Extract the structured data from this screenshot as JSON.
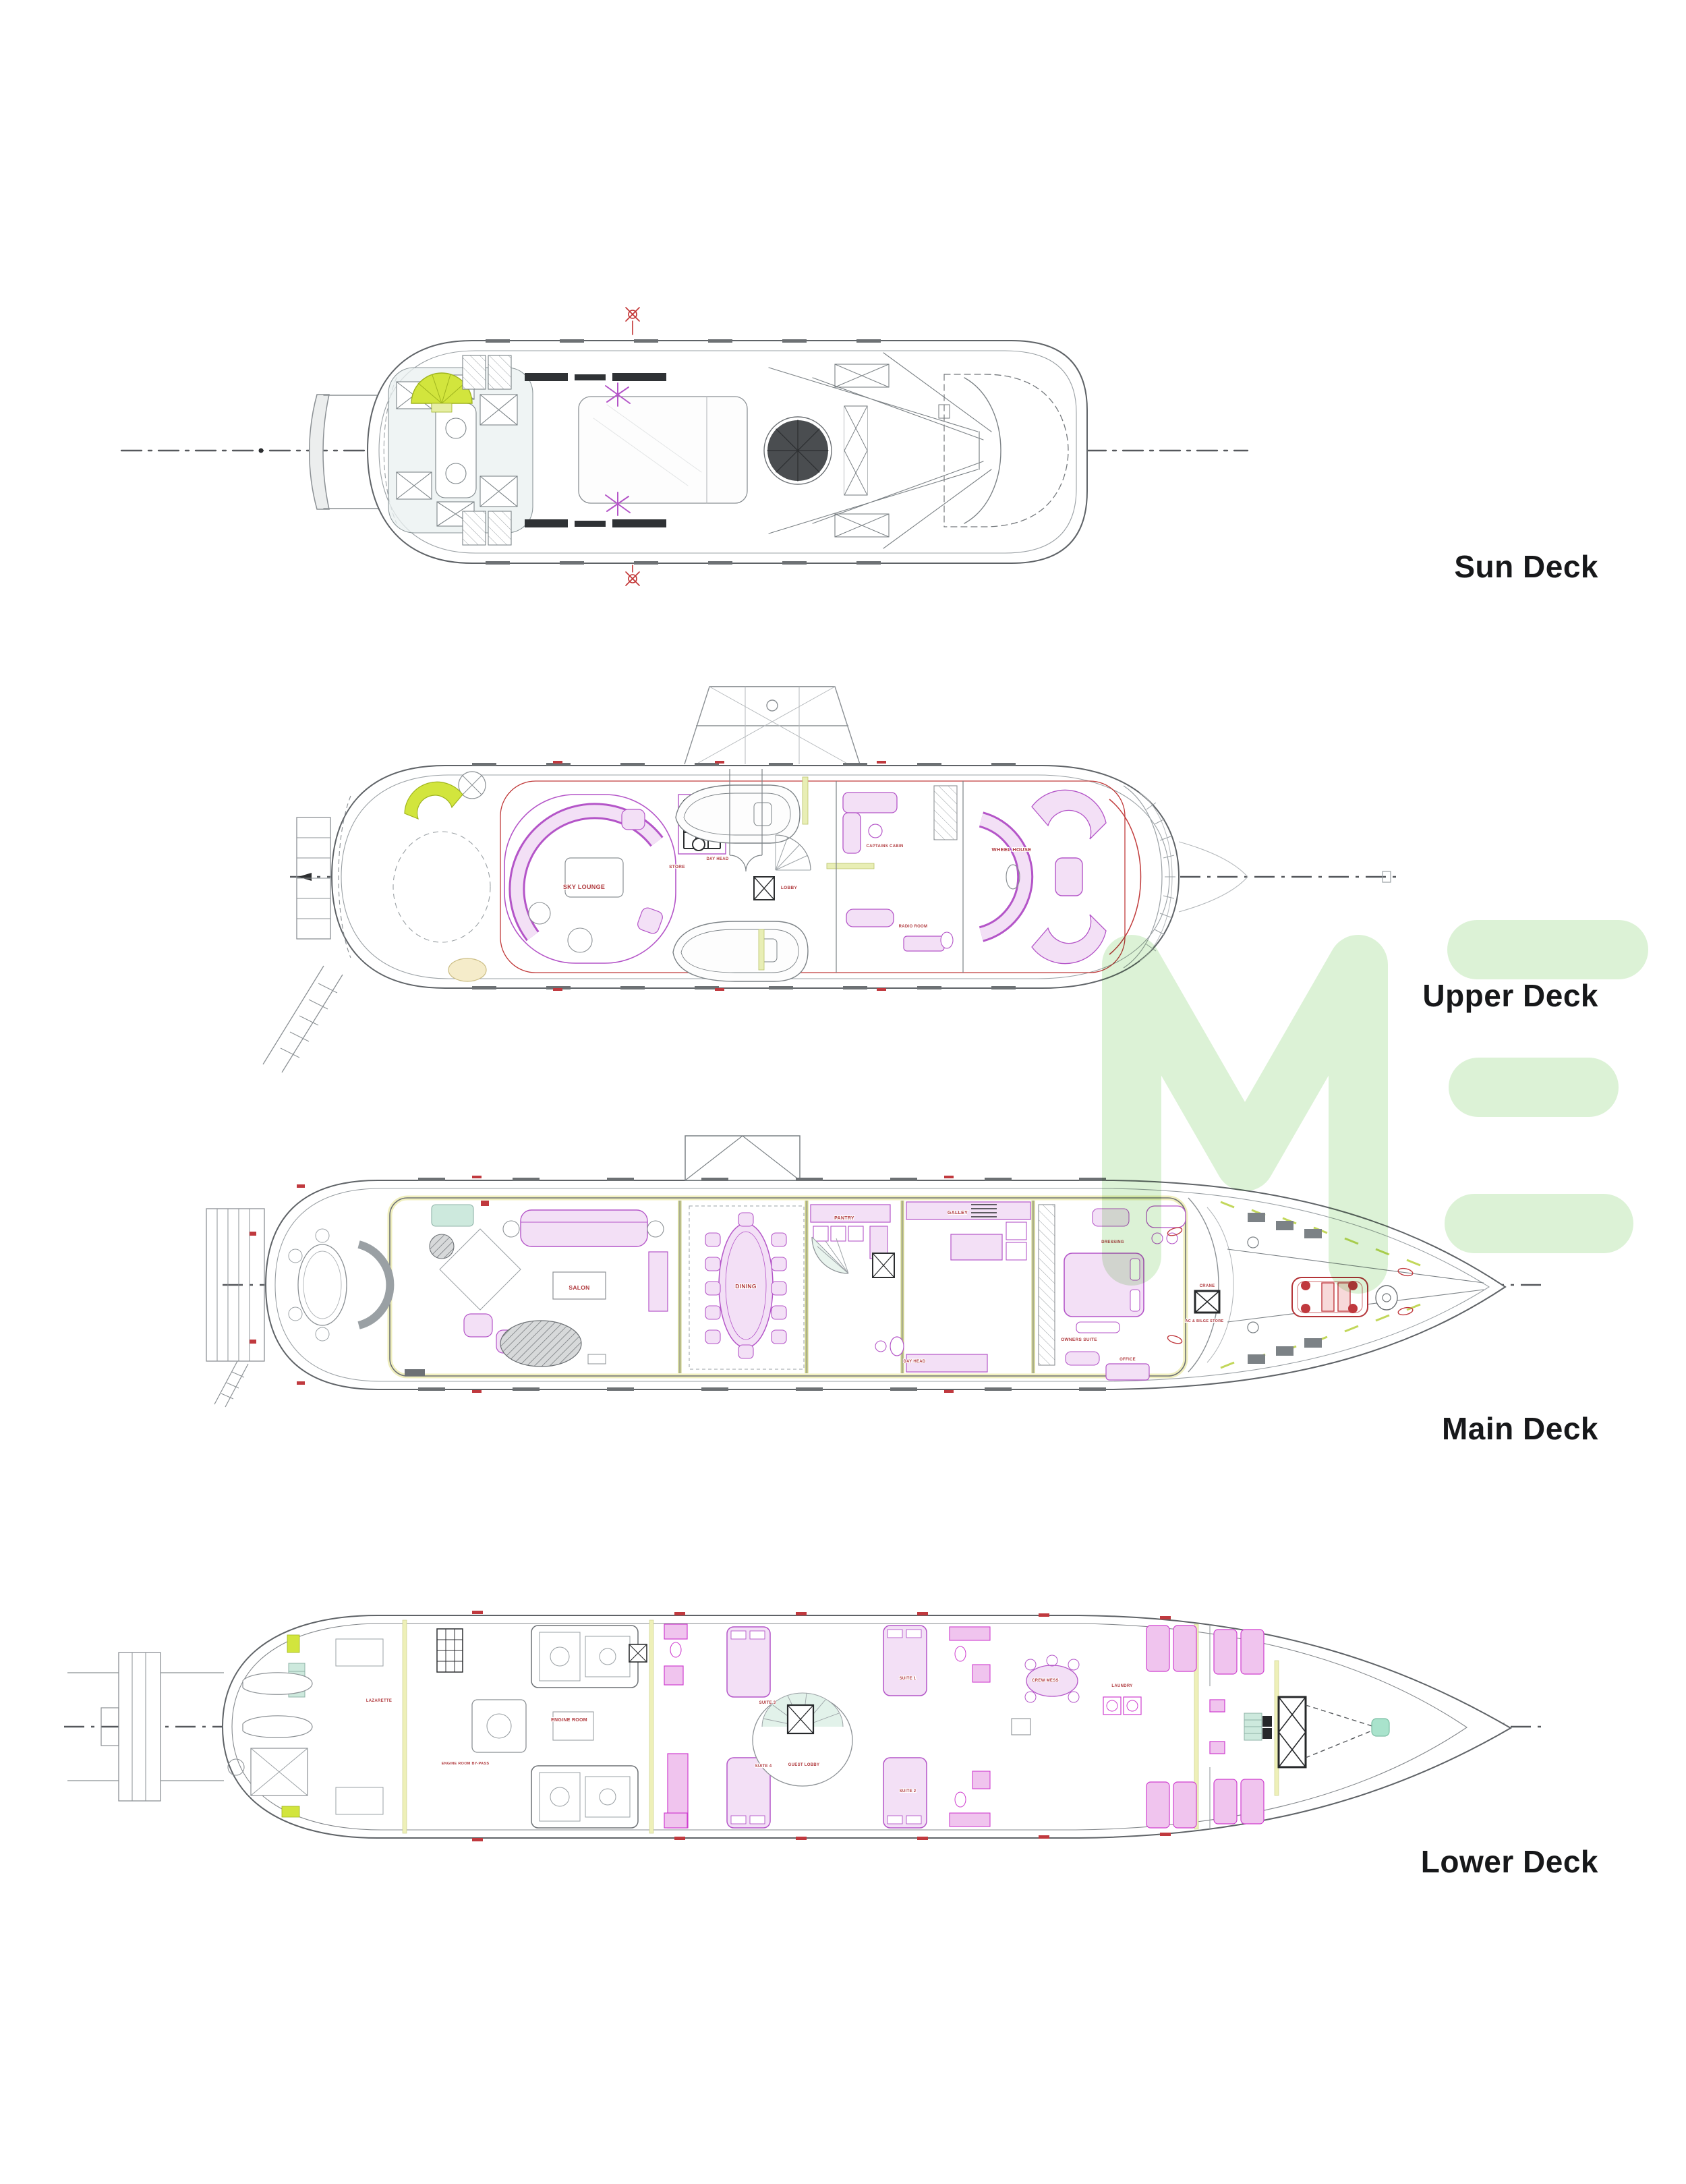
{
  "page": {
    "background": "#ffffff"
  },
  "watermark": {
    "text": "ME",
    "color": "#dcf2d6"
  },
  "palette": {
    "line": "#5f6367",
    "line_light": "#9aa0a4",
    "dark": "#2c2e30",
    "magenta": "#b455c8",
    "magenta_fill": "#f3e0f6",
    "magenta_bright": "#cf3ecf",
    "red": "#b03a3e",
    "chartreuse": "#d2e53d",
    "pale_yellow": "#f0efbe",
    "mint": "#cde9dd",
    "label": "#17181a",
    "watermark_green": "#dcf2d6"
  },
  "decks": [
    {
      "id": "sun-deck",
      "label": "Sun Deck",
      "rooms": []
    },
    {
      "id": "upper-deck",
      "label": "Upper Deck",
      "rooms": [
        {
          "label": "SKY LOUNGE"
        },
        {
          "label": "STORE"
        },
        {
          "label": "DAY HEAD"
        },
        {
          "label": "LOBBY"
        },
        {
          "label": "CAPTAINS CABIN"
        },
        {
          "label": "WHEEL HOUSE"
        },
        {
          "label": "RADIO ROOM"
        }
      ]
    },
    {
      "id": "main-deck",
      "label": "Main Deck",
      "rooms": [
        {
          "label": "SALON"
        },
        {
          "label": "DINING"
        },
        {
          "label": "PANTRY"
        },
        {
          "label": "GALLEY"
        },
        {
          "label": "DAY HEAD"
        },
        {
          "label": "DRESSING"
        },
        {
          "label": "OWNERS SUITE"
        },
        {
          "label": "OFFICE"
        },
        {
          "label": "CRANE"
        },
        {
          "label": "AC & BILGE STORE"
        }
      ]
    },
    {
      "id": "lower-deck",
      "label": "Lower Deck",
      "rooms": [
        {
          "label": "LAZARETTE"
        },
        {
          "label": "ENGINE ROOM"
        },
        {
          "label": "ENGINE ROOM BY-PASS"
        },
        {
          "label": "SUITE 3"
        },
        {
          "label": "SUITE 4"
        },
        {
          "label": "GUEST LOBBY"
        },
        {
          "label": "SUITE 1"
        },
        {
          "label": "SUITE 2"
        },
        {
          "label": "CREW MESS"
        },
        {
          "label": "LAUNDRY"
        }
      ]
    }
  ]
}
